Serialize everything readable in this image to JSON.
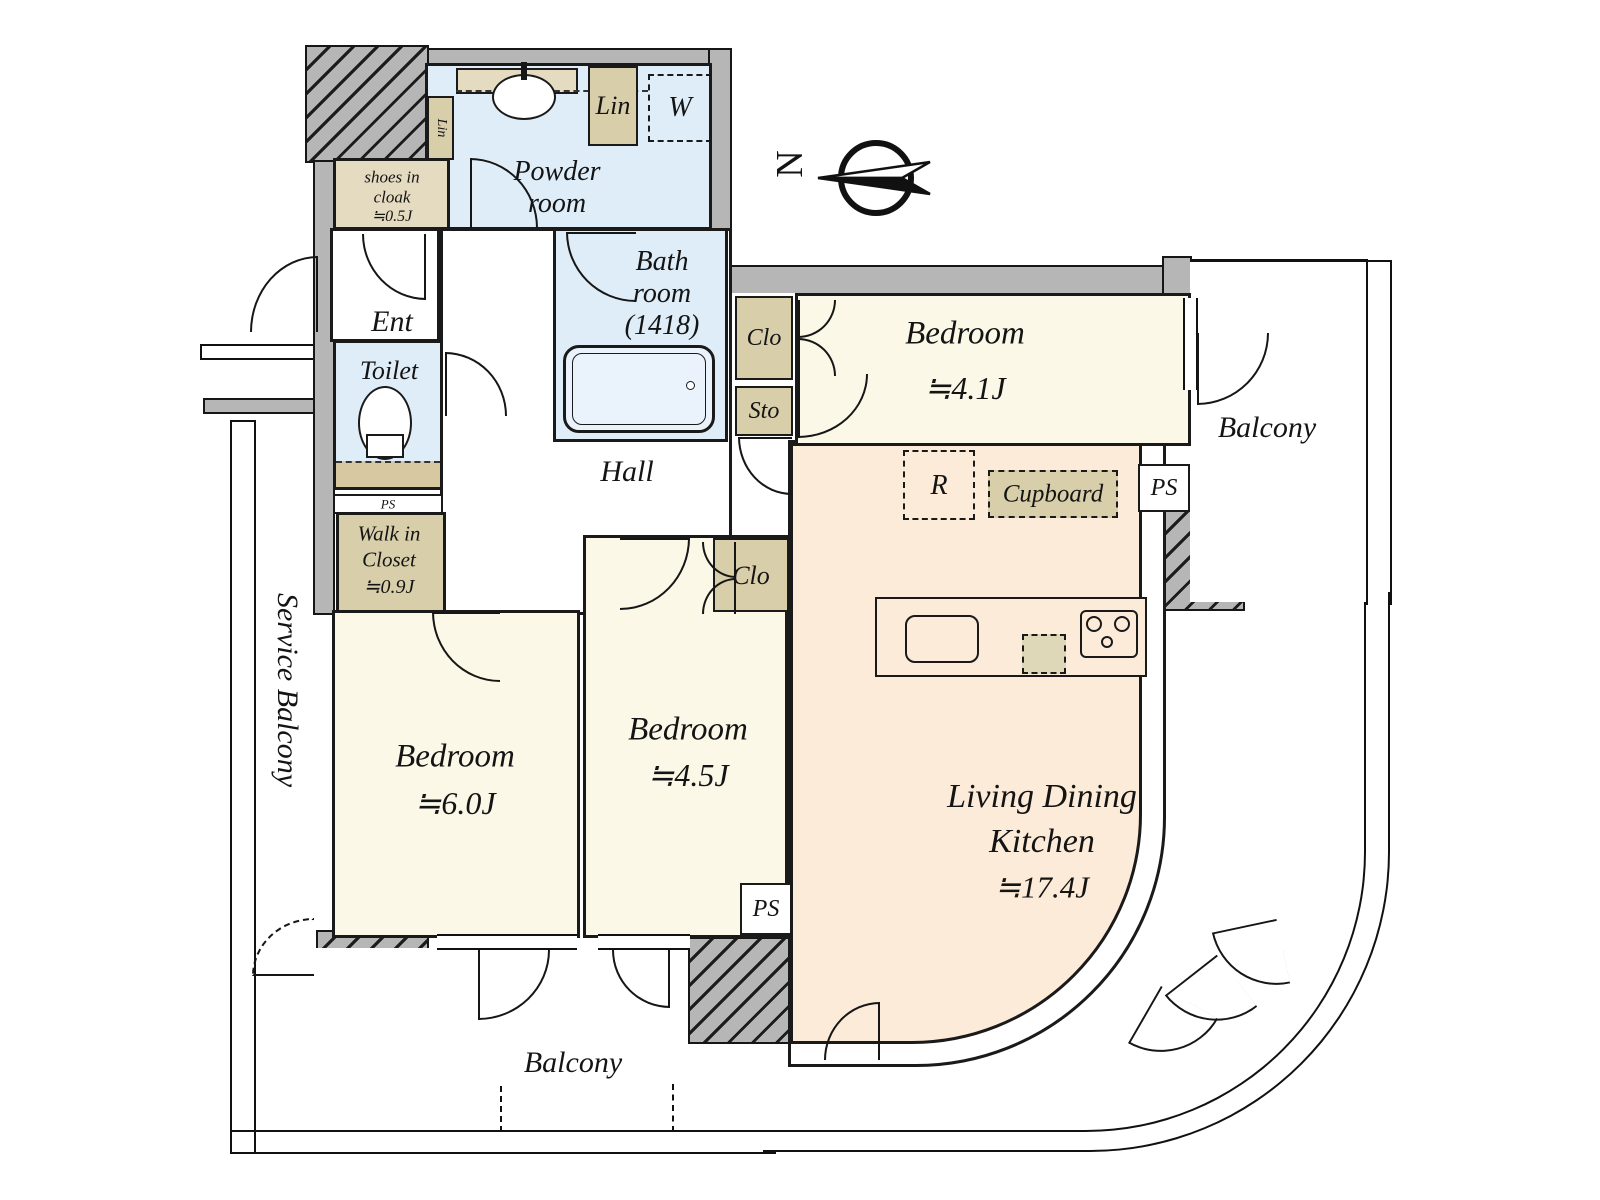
{
  "compass": {
    "label": "N"
  },
  "colors": {
    "wall": "#b6b6b6",
    "wet_area": "#dfedf8",
    "bedroom": "#fbf8e7",
    "ldk": "#fcebd8",
    "closet": "#d8ceaa",
    "cloak": "#e4dbc0",
    "line": "#1a1a1a"
  },
  "rooms": {
    "ent": {
      "label": "Ent"
    },
    "toilet": {
      "label": "Toilet"
    },
    "hall": {
      "label": "Hall"
    },
    "powder": {
      "line1": "Powder",
      "line2": "room"
    },
    "bath": {
      "line1": "Bath",
      "line2": "room",
      "line3": "(1418)"
    },
    "shoes_cloak": {
      "line1": "shoes in",
      "line2": "cloak",
      "size": "≒0.5J"
    },
    "walk_in_closet": {
      "line1": "Walk in",
      "line2": "Closet",
      "size": "≒0.9J"
    },
    "bedroom_41": {
      "name": "Bedroom",
      "size": "≒4.1J"
    },
    "bedroom_60": {
      "name": "Bedroom",
      "size": "≒6.0J"
    },
    "bedroom_45": {
      "name": "Bedroom",
      "size": "≒4.5J"
    },
    "ldk": {
      "line1": "Living Dining",
      "line2": "Kitchen",
      "size": "≒17.4J"
    },
    "balcony_right": {
      "label": "Balcony"
    },
    "balcony_bottom": {
      "label": "Balcony"
    },
    "service_balcony": {
      "label": "Service Balcony"
    }
  },
  "storage": {
    "lin_top": {
      "label": "Lin"
    },
    "lin_side": {
      "label": "Lin"
    },
    "washer": {
      "label": "W"
    },
    "clo_41": {
      "label": "Clo"
    },
    "sto_41": {
      "label": "Sto"
    },
    "clo_45": {
      "label": "Clo"
    },
    "cupboard": {
      "label": "Cupboard"
    },
    "refrigerator": {
      "label": "R"
    },
    "ps_kitchen": {
      "label": "PS"
    },
    "ps_bedroom45": {
      "label": "PS"
    },
    "ps_toilet": {
      "label": "PS"
    }
  }
}
